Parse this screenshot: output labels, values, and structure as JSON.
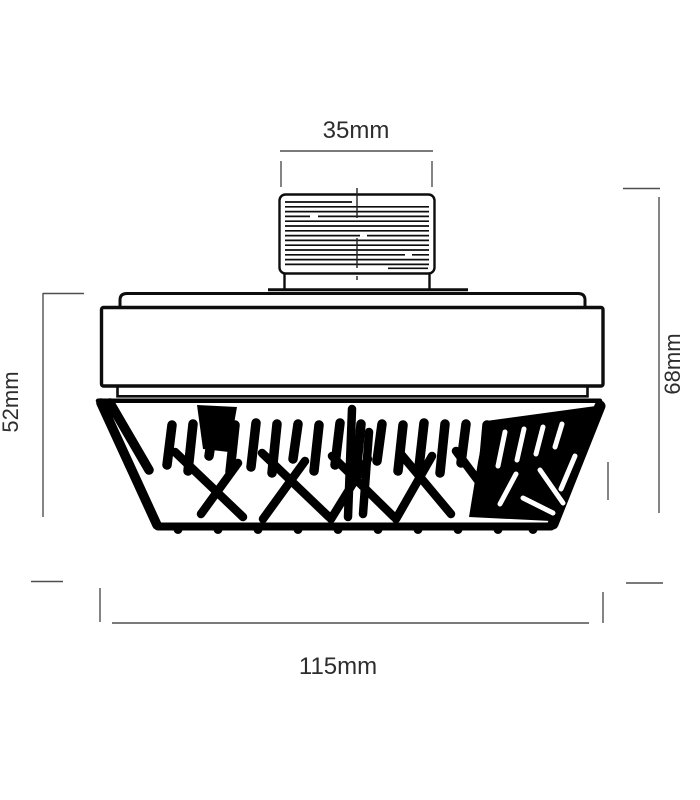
{
  "diagram": {
    "labels": {
      "top": "35mm",
      "left": "52mm",
      "right": "68mm",
      "bottom": "115mm"
    },
    "colors": {
      "background": "#ffffff",
      "outline": "#0d0d0d",
      "fins": "#000000",
      "dimension_lines": "#4f4f4f",
      "centerline": "#222222",
      "text": "#2d2d2d"
    }
  }
}
